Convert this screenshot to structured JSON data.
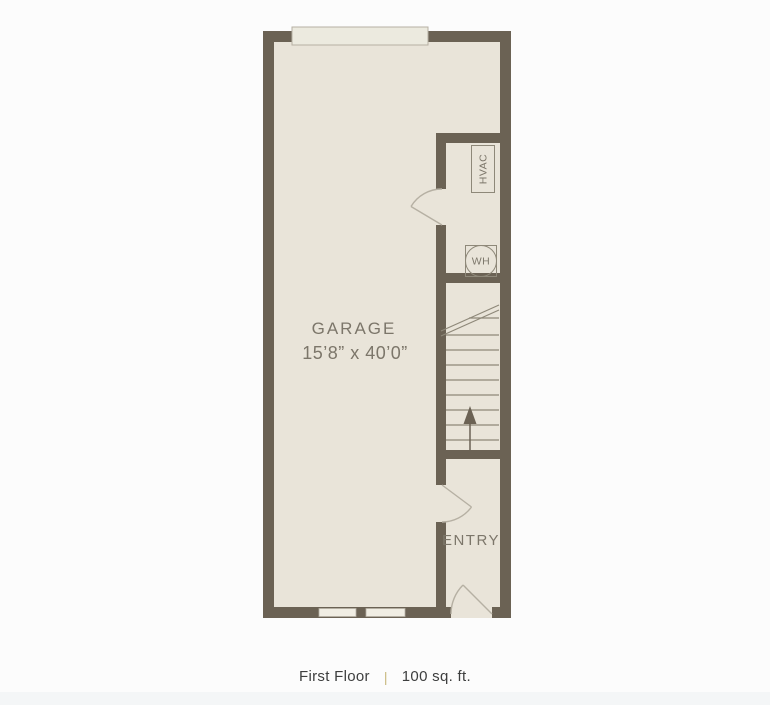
{
  "plan": {
    "garage": {
      "label": "GARAGE",
      "dimensions": "15’8” x 40’0”"
    },
    "entry": {
      "label": "ENTRY"
    },
    "hvac": {
      "label": "HVAC"
    },
    "water_heater": {
      "label": "WH"
    },
    "stairs": {
      "direction": "up",
      "tread_count": 8
    }
  },
  "footer": {
    "floor_label": "First Floor",
    "separator": "|",
    "area": "100 sq. ft."
  },
  "colors": {
    "wall": "#6b6254",
    "floor": "#e9e4d9",
    "door_line": "#b6b0a3",
    "stair_line": "#8e8879",
    "plan_text": "#7c766a",
    "footer_text": "#3d3e3e",
    "separator": "#c8b87e",
    "background": "#fcfcfc"
  }
}
